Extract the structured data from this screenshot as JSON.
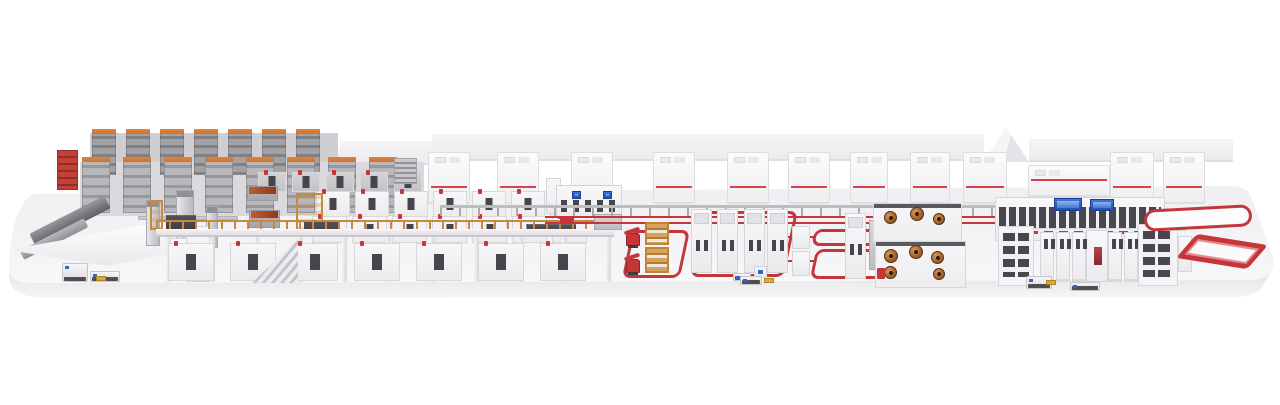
{
  "scene": {
    "name": "production-line-3d-render",
    "description": "Isometric 3D overview render of a complete automated production line on a floating white platform: high-bay storage racks, mezzanine coating line with orange railings, long rows of white process modules, enclosure cabinets with red stripes, robot cells inside red floor safety loops, winder cells with copper rolls, a finishing line with glass corridor and blue control screens, and red return conveyors",
    "background": "#ffffff",
    "palette": {
      "platform_floor": "#f2f2f5",
      "platform_face": "#e6e6ea",
      "machine_white": "#f6f5f7",
      "machine_border": "#d6d5d9",
      "machine_gray": "#c6c6ca",
      "rack_gray_dark": "#808085",
      "rack_gray_light": "#b8b8bc",
      "accent_red": "#c5363b",
      "stripe_red": "#d2454b",
      "cap_orange": "#d4702d",
      "scaffold_orange": "#c8893f",
      "wood": "#c99d62",
      "copper": "#a86a30",
      "panel_dark": "#45454b",
      "screen_blue": "#2f66cd",
      "pallet_yellow": "#d9aa3a"
    },
    "layers": [
      {
        "type": "blocks",
        "name": "backdrop",
        "items": [
          {
            "n": "roof-slab",
            "cls": "slab",
            "x": 250,
            "y": 149,
            "w": 92,
            "h": 17
          },
          {
            "n": "roof-slab",
            "cls": "slab",
            "x": 340,
            "y": 141,
            "w": 94,
            "h": 24
          },
          {
            "n": "roof-slab",
            "cls": "slab",
            "x": 432,
            "y": 134,
            "w": 552,
            "h": 27
          },
          {
            "n": "roof-gable",
            "cls": "gable",
            "x": 983,
            "y": 127,
            "w": 46,
            "h": 35
          },
          {
            "n": "roof-slab",
            "cls": "slab",
            "x": 1029,
            "y": 139,
            "w": 204,
            "h": 23
          }
        ]
      },
      {
        "type": "blocks",
        "name": "rack-walls",
        "items": [
          {
            "n": "rack-wall",
            "cls": "rackwall",
            "x": 90,
            "y": 133,
            "w": 248,
            "h": 44
          },
          {
            "n": "rack-wall",
            "cls": "rackwall2",
            "x": 80,
            "y": 162,
            "w": 344,
            "h": 54
          }
        ]
      },
      {
        "type": "row",
        "name": "storage-tower-back",
        "cls": "stower row1",
        "x0": 92,
        "y": 129,
        "w": 24,
        "step": 34,
        "count": 7,
        "h": 46
      },
      {
        "type": "row",
        "name": "storage-tower-front",
        "cls": "stower row2",
        "x0": 82,
        "y": 157,
        "w": 28,
        "step": 41,
        "count": 8,
        "h": 56
      },
      {
        "type": "cabrow",
        "name": "enclosure-cabinet",
        "y": 152,
        "w": 42,
        "h": 52,
        "items": [
          {
            "x": 428
          },
          {
            "x": 497
          },
          {
            "x": 571
          },
          {
            "x": 653
          },
          {
            "x": 727
          },
          {
            "x": 788
          },
          {
            "x": 850,
            "w": 38
          },
          {
            "x": 910,
            "w": 40
          },
          {
            "x": 963,
            "w": 44
          },
          {
            "x": 1028,
            "y": 165,
            "w": 82,
            "h": 32
          },
          {
            "x": 1110,
            "w": 44
          },
          {
            "x": 1163,
            "w": 42
          }
        ]
      },
      {
        "type": "blocks",
        "name": "infeed-area",
        "items": [
          {
            "n": "outfeed-ramp",
            "cls": "ramp",
            "x": 28,
            "y": 214,
            "w": 84,
            "h": 14,
            "rot": -27
          },
          {
            "n": "outfeed-ramp-lower",
            "cls": "ramp2",
            "x": 18,
            "y": 234,
            "w": 72,
            "h": 10,
            "rot": -27
          },
          {
            "n": "red-storage-rack",
            "cls": "redrack",
            "x": 57,
            "y": 150,
            "w": 21,
            "h": 40
          },
          {
            "n": "infeed-table",
            "cls": "table",
            "x": 8,
            "y": 224,
            "w": 236,
            "h": 42
          },
          {
            "n": "gantry-beam",
            "cls": "gbeam",
            "x": 138,
            "y": 216,
            "w": 100,
            "h": 4
          },
          {
            "n": "gantry-unit",
            "cls": "gpost",
            "x": 146,
            "y": 200,
            "w": 14,
            "h": 46
          },
          {
            "n": "gantry-unit",
            "cls": "gpost",
            "x": 176,
            "y": 190,
            "w": 18,
            "h": 60
          },
          {
            "n": "gantry-unit",
            "cls": "gpost",
            "x": 206,
            "y": 206,
            "w": 12,
            "h": 42
          },
          {
            "n": "infeed-machine",
            "cls": "machwhite",
            "x": 166,
            "y": 238,
            "w": 46,
            "h": 42
          },
          {
            "n": "infeed-tower",
            "cls": "machwhite",
            "x": 186,
            "y": 226,
            "w": 24,
            "h": 56
          }
        ]
      },
      {
        "type": "row",
        "name": "backline-module",
        "cls": "module mgray",
        "x0": 258,
        "y": 172,
        "w": 28,
        "step": 34,
        "count": 5,
        "h": 20
      },
      {
        "type": "row",
        "name": "press-module-back",
        "cls": "module",
        "x0": 316,
        "y": 191,
        "w": 34,
        "step": 39,
        "count": 7,
        "h": 26
      },
      {
        "type": "row",
        "name": "press-module-front",
        "cls": "module",
        "x0": 312,
        "y": 216,
        "w": 35,
        "step": 40,
        "count": 7,
        "h": 27
      },
      {
        "type": "blocks",
        "name": "mezzanine",
        "items": [
          {
            "n": "coating-head",
            "cls": "coppertop",
            "x": 247,
            "y": 186,
            "w": 31,
            "h": 15
          },
          {
            "n": "coating-head",
            "cls": "coppertop",
            "x": 249,
            "y": 210,
            "w": 31,
            "h": 18
          },
          {
            "n": "scaffold",
            "cls": "scaffold",
            "x": 150,
            "y": 200,
            "w": 13,
            "h": 30
          },
          {
            "n": "scaffold-tower",
            "cls": "scaffold",
            "x": 296,
            "y": 193,
            "w": 27,
            "h": 44
          },
          {
            "n": "louver-stack",
            "cls": "louver",
            "x": 394,
            "y": 158,
            "w": 23,
            "h": 26
          },
          {
            "n": "control-panel",
            "cls": "darkpanel",
            "x": 166,
            "y": 215,
            "w": 30,
            "h": 16
          },
          {
            "n": "control-panel",
            "cls": "darkpanel",
            "x": 304,
            "y": 221,
            "w": 34,
            "h": 15
          },
          {
            "n": "control-panel",
            "cls": "darkpanel",
            "x": 528,
            "y": 224,
            "w": 48,
            "h": 13
          },
          {
            "n": "mezzanine-railing",
            "cls": "railing",
            "x": 156,
            "y": 220,
            "w": 458,
            "h": 9
          },
          {
            "n": "mezzanine-deck",
            "cls": "deck",
            "x": 156,
            "y": 229,
            "w": 458,
            "h": 8
          }
        ]
      },
      {
        "type": "row",
        "name": "deck-pillar",
        "cls": "pillar",
        "x0": 166,
        "y": 237,
        "w": 5,
        "step": 44,
        "count": 11,
        "h": 45
      },
      {
        "type": "row",
        "name": "underdeck-module",
        "cls": "module big",
        "x0": 168,
        "y": 243,
        "w": 46,
        "step": 62,
        "count": 7,
        "h": 38
      },
      {
        "type": "blocks",
        "name": "mezzanine-front",
        "items": [
          {
            "n": "staircase",
            "cls": "stairs",
            "x": 252,
            "y": 239,
            "w": 46,
            "h": 44
          },
          {
            "n": "portal-frame",
            "cls": "machwhite",
            "x": 546,
            "y": 178,
            "w": 15,
            "h": 36
          },
          {
            "n": "control-cabinet",
            "cls": "midcab",
            "x": 556,
            "y": 185,
            "w": 66,
            "h": 32
          },
          {
            "n": "hmi-screen",
            "cls": "screenb",
            "x": 572,
            "y": 191,
            "w": 9,
            "h": 8
          },
          {
            "n": "hmi-screen",
            "cls": "screenb",
            "x": 603,
            "y": 191,
            "w": 9,
            "h": 8
          },
          {
            "n": "floor-machine",
            "cls": "machgray",
            "x": 594,
            "y": 214,
            "w": 28,
            "h": 16
          }
        ]
      },
      {
        "type": "blocks",
        "name": "floor-conveyors",
        "items": [
          {
            "n": "roller-conveyor",
            "cls": "grayline",
            "x": 440,
            "y": 205,
            "w": 562,
            "h": 3
          },
          {
            "n": "red-transfer-line",
            "cls": "redline",
            "x": 545,
            "y": 216,
            "w": 606,
            "h": 8
          },
          {
            "n": "transfer-cart",
            "cls": "redcart",
            "x": 560,
            "y": 217,
            "w": 14,
            "h": 6
          },
          {
            "n": "transfer-cart",
            "cls": "redcart",
            "x": 700,
            "y": 217,
            "w": 12,
            "h": 6
          },
          {
            "n": "transfer-cart",
            "cls": "redcart",
            "x": 1000,
            "y": 217,
            "w": 14,
            "h": 6
          },
          {
            "n": "red-link",
            "cls": "redstub",
            "x": 788,
            "y": 236,
            "w": 28,
            "h": 2
          },
          {
            "n": "red-link",
            "cls": "redstub",
            "x": 788,
            "y": 260,
            "w": 28,
            "h": 2
          }
        ]
      },
      {
        "type": "blocks",
        "name": "robot-cells",
        "items": [
          {
            "n": "safety-loop",
            "cls": "redloop",
            "x": 627,
            "y": 230,
            "w": 58,
            "h": 48
          },
          {
            "n": "safety-loop",
            "cls": "redloop",
            "x": 697,
            "y": 211,
            "w": 94,
            "h": 66
          },
          {
            "n": "pallet-rack",
            "cls": "woodrack",
            "x": 645,
            "y": 222,
            "w": 24,
            "h": 23
          },
          {
            "n": "pallet-rack",
            "cls": "woodrack",
            "x": 645,
            "y": 247,
            "w": 24,
            "h": 26
          },
          {
            "n": "robot-arm",
            "cls": "robot",
            "x": 626,
            "y": 233,
            "w": 14,
            "h": 13
          },
          {
            "n": "robot-arm",
            "cls": "robot",
            "x": 626,
            "y": 259,
            "w": 14,
            "h": 14
          }
        ]
      },
      {
        "type": "row",
        "name": "process-tower",
        "cls": "celltower",
        "xs": [
          691,
          717,
          744,
          767
        ],
        "y": 209,
        "w": 21,
        "h": 64
      },
      {
        "type": "blocks",
        "name": "robot-cell-extras",
        "items": [
          {
            "n": "shuttle-cart",
            "cls": "agv low",
            "x": 733,
            "y": 273,
            "w": 18,
            "h": 8
          },
          {
            "n": "control-box",
            "cls": "machwhite bluedot",
            "x": 754,
            "y": 266,
            "w": 13,
            "h": 12
          }
        ]
      },
      {
        "type": "blocks",
        "name": "winder-cells",
        "items": [
          {
            "n": "safety-loop",
            "cls": "redloop",
            "x": 813,
            "y": 229,
            "w": 127,
            "h": 17
          },
          {
            "n": "safety-loop",
            "cls": "redloop",
            "x": 813,
            "y": 249,
            "w": 129,
            "h": 30
          },
          {
            "n": "cell-cabinet",
            "cls": "machwhite",
            "x": 792,
            "y": 226,
            "w": 18,
            "h": 23
          },
          {
            "n": "cell-cabinet",
            "cls": "machwhite",
            "x": 792,
            "y": 251,
            "w": 18,
            "h": 25
          },
          {
            "n": "process-tower",
            "cls": "celltower",
            "x": 845,
            "y": 213,
            "w": 21,
            "h": 66
          },
          {
            "n": "gray-column",
            "cls": "machgray",
            "x": 869,
            "y": 220,
            "w": 10,
            "h": 50
          },
          {
            "n": "winder-machine",
            "cls": "windbox",
            "x": 873,
            "y": 203,
            "w": 89,
            "h": 40
          },
          {
            "n": "winder-machine",
            "cls": "windbox",
            "x": 875,
            "y": 241,
            "w": 91,
            "h": 47
          }
        ]
      },
      {
        "type": "rolls",
        "name": "copper-roll",
        "items": [
          {
            "x": 884,
            "y": 211,
            "d": 13
          },
          {
            "x": 910,
            "y": 207,
            "d": 14
          },
          {
            "x": 933,
            "y": 213,
            "d": 12
          },
          {
            "x": 884,
            "y": 249,
            "d": 14
          },
          {
            "x": 909,
            "y": 245,
            "d": 14
          },
          {
            "x": 884,
            "y": 266,
            "d": 13
          },
          {
            "x": 931,
            "y": 251,
            "d": 13
          },
          {
            "x": 933,
            "y": 268,
            "d": 12
          }
        ]
      },
      {
        "type": "blocks",
        "name": "winder-extras",
        "items": [
          {
            "n": "red-unit",
            "cls": "redcart",
            "x": 877,
            "y": 268,
            "w": 8,
            "h": 11
          }
        ]
      },
      {
        "type": "blocks",
        "name": "finishing-line",
        "items": [
          {
            "n": "line-frame",
            "cls": "machwhite",
            "x": 995,
            "y": 197,
            "w": 170,
            "h": 44
          },
          {
            "n": "glass-corridor",
            "cls": "glassgrid",
            "x": 999,
            "y": 205,
            "w": 162,
            "h": 24
          },
          {
            "n": "red-dash-strip",
            "cls": "reddash",
            "x": 999,
            "y": 231,
            "w": 162,
            "h": 3
          },
          {
            "n": "line-screen",
            "cls": "screenb",
            "x": 1054,
            "y": 198,
            "w": 28,
            "h": 13
          },
          {
            "n": "line-screen",
            "cls": "screenb",
            "x": 1090,
            "y": 199,
            "w": 24,
            "h": 12
          },
          {
            "n": "end-box",
            "cls": "machwhite",
            "x": 1160,
            "y": 213,
            "w": 26,
            "h": 18
          },
          {
            "n": "window-tower",
            "cls": "wingrid",
            "x": 998,
            "y": 226,
            "w": 36,
            "h": 60
          },
          {
            "n": "center-cabinet",
            "cls": "machwhite redwin",
            "x": 1086,
            "y": 230,
            "w": 22,
            "h": 52
          }
        ]
      },
      {
        "type": "row",
        "name": "finishing-cabinet",
        "cls": "slotcab",
        "x0": 1040,
        "y": 232,
        "w": 14,
        "step": 16,
        "count": 3,
        "h": 50
      },
      {
        "type": "row",
        "name": "finishing-cabinet",
        "cls": "slotcab",
        "x0": 1108,
        "y": 232,
        "w": 14,
        "step": 16,
        "count": 2,
        "h": 50
      },
      {
        "type": "blocks",
        "name": "finishing-right",
        "items": [
          {
            "n": "window-tower",
            "cls": "wingrid",
            "x": 1138,
            "y": 224,
            "w": 40,
            "h": 62
          },
          {
            "n": "side-unit",
            "cls": "machwhite",
            "x": 1178,
            "y": 236,
            "w": 14,
            "h": 36
          },
          {
            "n": "return-conveyor",
            "cls": "stadium",
            "x": 1144,
            "y": 207,
            "w": 108,
            "h": 22,
            "rot": -3
          },
          {
            "n": "return-loop",
            "cls": "isoloop",
            "x": 1186,
            "y": 238,
            "w": 72,
            "h": 27
          }
        ]
      },
      {
        "type": "blocks",
        "name": "vehicles",
        "items": [
          {
            "n": "agv",
            "cls": "agv",
            "x": 62,
            "y": 263,
            "w": 26,
            "h": 19
          },
          {
            "n": "pallet-truck",
            "cls": "agv low",
            "x": 90,
            "y": 271,
            "w": 30,
            "h": 11
          },
          {
            "n": "pallet",
            "cls": "pallet",
            "x": 96,
            "y": 276,
            "w": 10,
            "h": 5
          },
          {
            "n": "shuttle-cart",
            "cls": "agv low",
            "x": 740,
            "y": 276,
            "w": 22,
            "h": 9
          },
          {
            "n": "pallet",
            "cls": "pallet",
            "x": 764,
            "y": 278,
            "w": 10,
            "h": 5
          },
          {
            "n": "agv",
            "cls": "agv",
            "x": 1026,
            "y": 276,
            "w": 26,
            "h": 13
          },
          {
            "n": "pallet",
            "cls": "pallet",
            "x": 1046,
            "y": 280,
            "w": 10,
            "h": 5
          },
          {
            "n": "pallet-truck",
            "cls": "agv low",
            "x": 1070,
            "y": 282,
            "w": 30,
            "h": 9
          }
        ]
      }
    ]
  }
}
